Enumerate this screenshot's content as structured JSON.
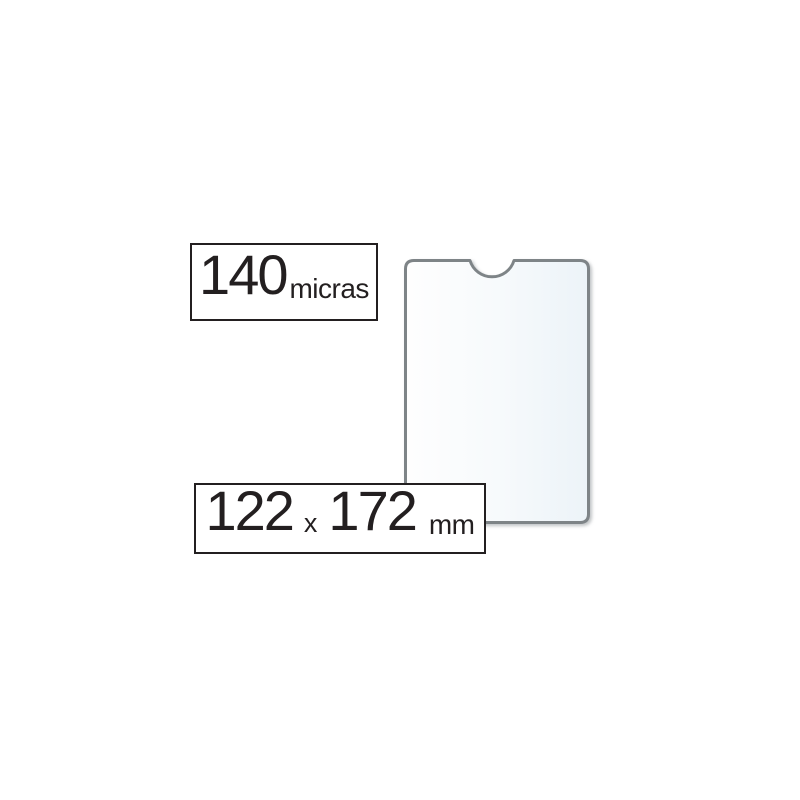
{
  "badges": {
    "thickness": {
      "value": "140",
      "unit": "micras"
    },
    "dimensions": {
      "width": "122",
      "separator": "x",
      "height": "172",
      "unit": "mm"
    }
  },
  "colors": {
    "background": "#ffffff",
    "text": "#231f20",
    "badge_border": "#231f20",
    "sleeve_border": "#7e8487",
    "sleeve_fill_left": "#fefefe",
    "sleeve_fill_mid": "#f7fafc",
    "sleeve_fill_right": "#ecf3f8"
  }
}
